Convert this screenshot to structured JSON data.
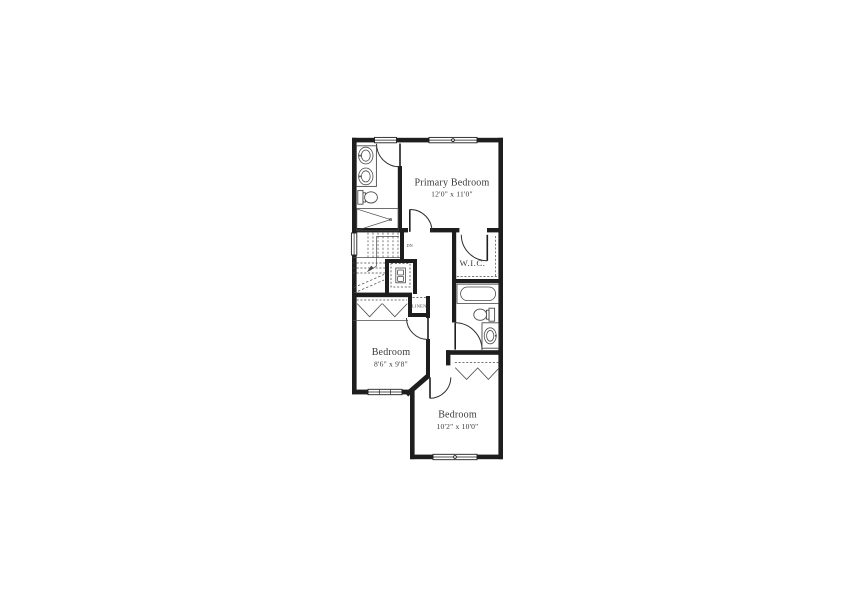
{
  "rooms": {
    "primary_bedroom": {
      "label": "Primary Bedroom",
      "dims": "12'0\" x 11'0\""
    },
    "walk_in_closet": {
      "label": "W.I.C."
    },
    "bedroom_left": {
      "label": "Bedroom",
      "dims": "8'6\" x 9'8\""
    },
    "bedroom_bottom": {
      "label": "Bedroom",
      "dims": "10'2\" x 10'0\""
    },
    "linen_closet": {
      "label": "LINEN"
    },
    "stairs": {
      "down_label": "DN"
    }
  },
  "fixtures": {
    "bath_primary": [
      "double-vanity-sinks",
      "toilet",
      "shower"
    ],
    "bath_hall": [
      "bathtub",
      "toilet",
      "vanity-sink"
    ],
    "utility": [
      "stacked-washer-dryer"
    ],
    "closets": [
      "bifold-chevron-doors",
      "shelf-dashed-lines"
    ],
    "stairs": [
      "stair-treads",
      "down-direction-arrow"
    ]
  },
  "colors": {
    "wall": "#1e1e1e",
    "fixture": "#4a4a4a",
    "ink": "#3a3a38",
    "background": "#ffffff"
  }
}
